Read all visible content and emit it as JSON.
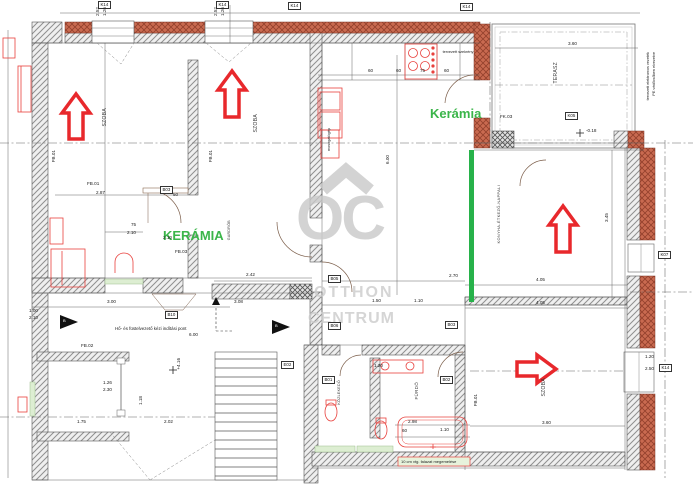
{
  "watermark": {
    "monogram": "OC",
    "word1": "OTTHON",
    "word2": "CENTRUM"
  },
  "material_labels": {
    "kitchen": "Kerámia",
    "hall": "KERÁMIA"
  },
  "room_labels": {
    "room1": "SZOBA",
    "room2": "SZOBA",
    "living": "KONYHA-ÉTKEZŐ-NAPPALI",
    "bath": "FÜRDŐ",
    "bedroom": "SZOBA",
    "terrace": "TERASZ",
    "wardrobe": "GARDRÓB",
    "hallway": "KÖZLEKEDŐ"
  },
  "tags": {
    "k14": "K14",
    "k05": "K05",
    "k07": "K07",
    "b01": "B01",
    "b02": "B02",
    "b03": "B03",
    "b05": "B05",
    "b06": "B06",
    "b10": "B10",
    "e02": "E02",
    "fk03": "FK.03",
    "fb01": "FB.01",
    "fb02": "FB.02",
    "fb03": "FB.03"
  },
  "dims": {
    "v287": "2.87",
    "v75": "75",
    "v210": "2.10",
    "v50": "50",
    "v242": "2.42",
    "v308": "3.08",
    "v300": "3.00",
    "v270": "2.70",
    "v150": "1.50",
    "v110": "1.10",
    "v405": "4.05",
    "v345": "3.45",
    "v600": "6.00",
    "v360": "3.60",
    "v120": "1.20",
    "v250": "2.50",
    "v298": "2.98",
    "v60": "60",
    "v126": "1.26",
    "v230": "2.30",
    "v175": "1.75",
    "v202": "2.02",
    "v118": "1.18",
    "v100": "1.00",
    "v252": "2.52",
    "elev_upper": "+4.16",
    "elev_terrace": "-0.18"
  },
  "notes": {
    "smoke_vent": "Hő- és füstelvezető kézi indítási pont",
    "kitchen_cabinet": "tervezett szekrény",
    "dishwasher": "mosogatógép",
    "masonry_red": "10 cm vtg. falazat megemelése",
    "margin_line1": "tervezett elektromos vezeték",
    "margin_line2": "PE védőcsőben elvezetve",
    "section_mark": "B"
  },
  "colors": {
    "arrow_red": "#e8282c",
    "fixture_red": "#e8413d",
    "accent_green": "#27b24a",
    "label_green": "#3bb54a",
    "brick": "#c4573e",
    "watermark_gray": "#c9c9c9",
    "pale_green_floor": "#ddeed2"
  }
}
